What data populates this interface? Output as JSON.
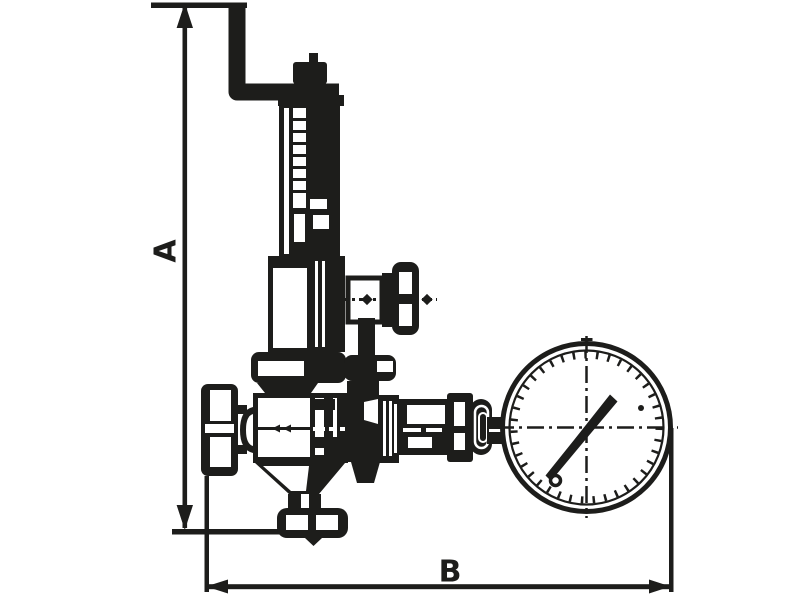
{
  "page": {
    "kind": "technical-line-drawing",
    "subject": "pressure reducing valve with adjusting lever, side handwheel and pressure gauge, dimensioned outline"
  },
  "colors": {
    "ink": "#1d1d1b",
    "background": "#ffffff"
  },
  "dimensions": {
    "a_label": "A",
    "b_label": "B"
  },
  "parts": [
    "dimension-line-a",
    "dimension-line-b",
    "adjusting-lever-handle",
    "stem-top-nut",
    "spring-housing-tube",
    "adjusting-screw-threads",
    "spring-bell-housing",
    "bell-flange",
    "side-stem-hex",
    "side-handwheel",
    "valve-body",
    "inlet-bulge",
    "inlet-cap",
    "body-taper",
    "outlet-neck",
    "outlet-bottom-flange",
    "gauge-branch-boss",
    "union-nut-1",
    "branch-pipe",
    "union-nut-2",
    "dome-adapter",
    "gauge-stem",
    "pressure-gauge-dial",
    "gauge-needle",
    "needle-counterweight",
    "centerline-crosshair"
  ]
}
